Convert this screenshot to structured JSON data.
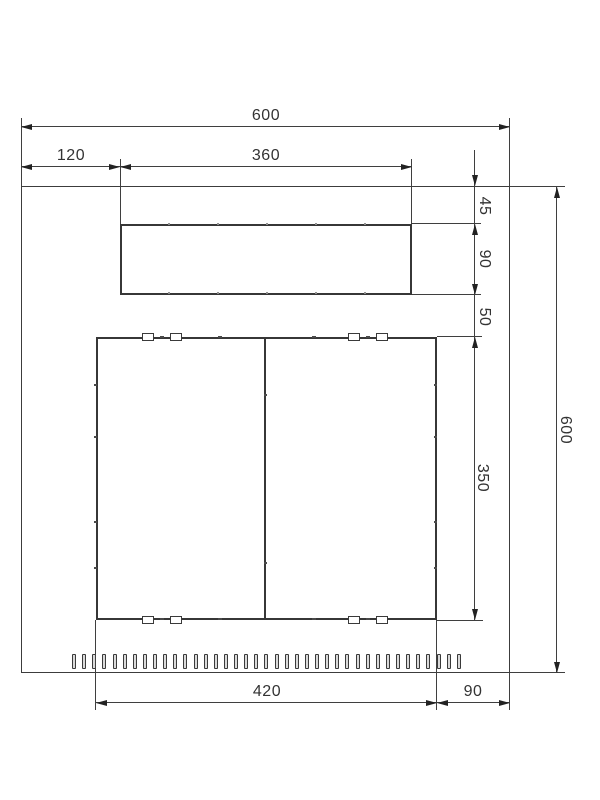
{
  "drawing": {
    "dims": {
      "overall_width": "600",
      "left_offset": "120",
      "vent_width": "360",
      "vent_top_gap": "45",
      "vent_height": "90",
      "vent_door_gap": "50",
      "door_height": "350",
      "overall_height": "600",
      "door_width": "420",
      "door_right_offset": "90"
    },
    "slot_count": 39,
    "colors": {
      "line": "#3c3c3c",
      "text": "#333333",
      "background": "#ffffff"
    }
  }
}
